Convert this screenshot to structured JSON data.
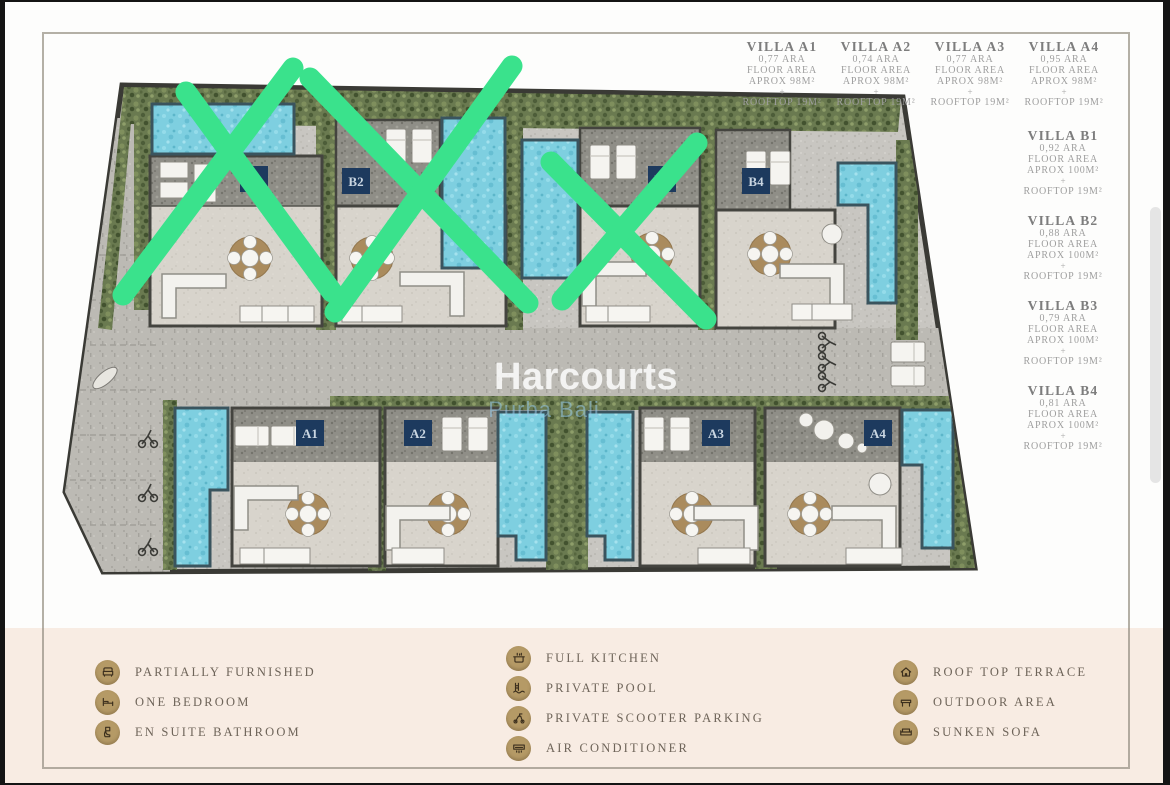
{
  "villa_info_top": [
    {
      "name": "VILLA A1",
      "area": "0,77 ARA",
      "floor": "FLOOR AREA",
      "aprox": "APROX 98M²",
      "plus": "+",
      "rooftop": "ROOFTOP 19M²"
    },
    {
      "name": "VILLA A2",
      "area": "0,74 ARA",
      "floor": "FLOOR AREA",
      "aprox": "APROX 98M²",
      "plus": "+",
      "rooftop": "ROOFTOP 19M²"
    },
    {
      "name": "VILLA A3",
      "area": "0,77 ARA",
      "floor": "FLOOR AREA",
      "aprox": "APROX 98M²",
      "plus": "+",
      "rooftop": "ROOFTOP 19M²"
    },
    {
      "name": "VILLA A4",
      "area": "0,95 ARA",
      "floor": "FLOOR AREA",
      "aprox": "APROX 98M²",
      "plus": "+",
      "rooftop": "ROOFTOP 19M²"
    }
  ],
  "villa_info_side": [
    {
      "name": "VILLA B1",
      "area": "0,92 ARA",
      "floor": "FLOOR AREA",
      "aprox": "APROX 100M²",
      "plus": "+",
      "rooftop": "ROOFTOP 19M²"
    },
    {
      "name": "VILLA B2",
      "area": "0,88 ARA",
      "floor": "FLOOR AREA",
      "aprox": "APROX 100M²",
      "plus": "+",
      "rooftop": "ROOFTOP 19M²"
    },
    {
      "name": "VILLA B3",
      "area": "0,79 ARA",
      "floor": "FLOOR AREA",
      "aprox": "APROX 100M²",
      "plus": "+",
      "rooftop": "ROOFTOP 19M²"
    },
    {
      "name": "VILLA B4",
      "area": "0,81 ARA",
      "floor": "FLOOR AREA",
      "aprox": "APROX 100M²",
      "plus": "+",
      "rooftop": "ROOFTOP 19M²"
    }
  ],
  "plan": {
    "watermark_line1": "Harcourts",
    "watermark_line2": "Purba Bali",
    "units": [
      {
        "label": "B1",
        "sold": true
      },
      {
        "label": "B2",
        "sold": true
      },
      {
        "label": "B3",
        "sold": true
      },
      {
        "label": "B4",
        "sold": false
      },
      {
        "label": "A1",
        "sold": false
      },
      {
        "label": "A2",
        "sold": false
      },
      {
        "label": "A3",
        "sold": false
      },
      {
        "label": "A4",
        "sold": false
      }
    ],
    "colors": {
      "sold_mark_green": "#3ae28c",
      "pool_blue": "#7ecfe0",
      "label_navy": "#1d3a5e",
      "cream_band": "#f8ece3",
      "legend_icon_tan": "#b59a66"
    }
  },
  "legend": {
    "column1": [
      {
        "icon": "armchair-icon",
        "label": "PARTIALLY FURNISHED"
      },
      {
        "icon": "bed-icon",
        "label": "ONE BEDROOM"
      },
      {
        "icon": "toilet-icon",
        "label": "EN SUITE BATHROOM"
      }
    ],
    "column2": [
      {
        "icon": "kitchen-pot-icon",
        "label": "FULL KITCHEN"
      },
      {
        "icon": "pool-ladder-icon",
        "label": "PRIVATE POOL"
      },
      {
        "icon": "scooter-icon",
        "label": "PRIVATE SCOOTER PARKING"
      },
      {
        "icon": "air-conditioner-icon",
        "label": "AIR CONDITIONER"
      }
    ],
    "column3": [
      {
        "icon": "house-icon",
        "label": "ROOF TOP TERRACE"
      },
      {
        "icon": "bench-icon",
        "label": "OUTDOOR AREA"
      },
      {
        "icon": "sofa-icon",
        "label": "SUNKEN SOFA"
      }
    ]
  }
}
